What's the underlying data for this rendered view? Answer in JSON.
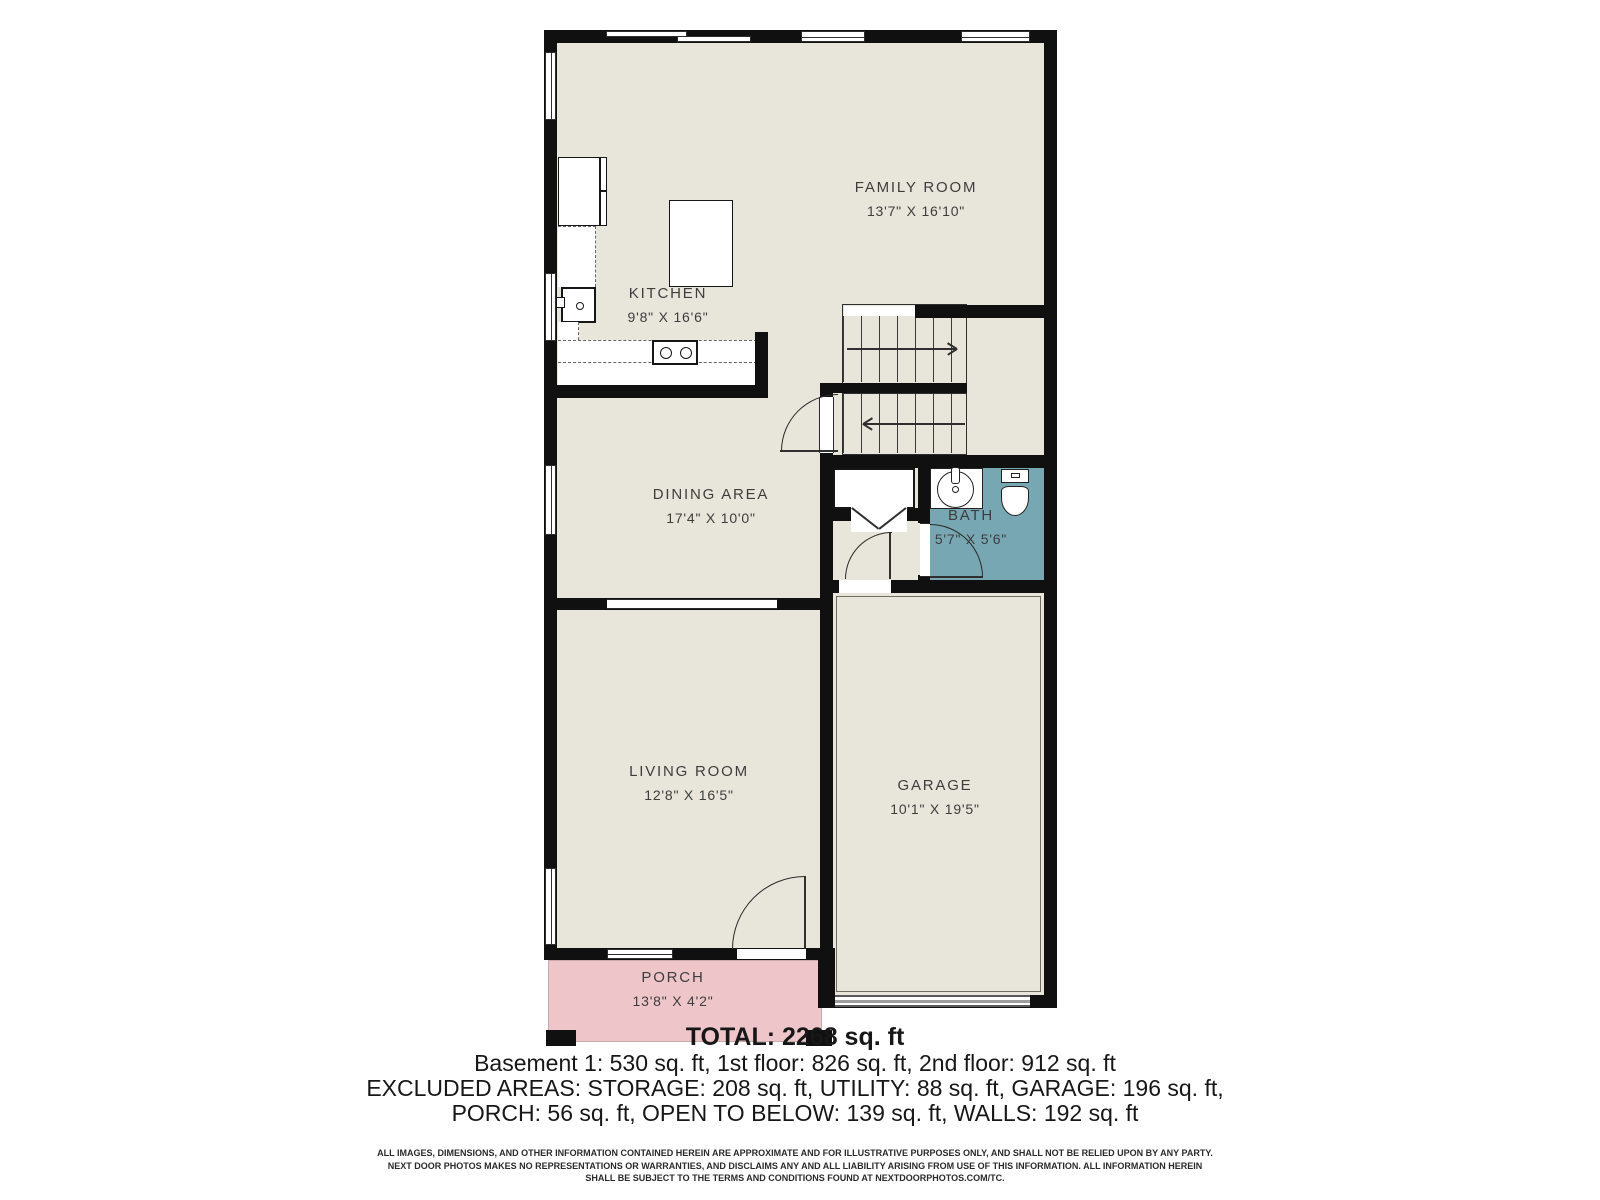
{
  "plan": {
    "rooms": {
      "family_room": {
        "name": "FAMILY ROOM",
        "dims": "13'7\" X 16'10\""
      },
      "kitchen": {
        "name": "KITCHEN",
        "dims": "9'8\" X 16'6\""
      },
      "dining_area": {
        "name": "DINING AREA",
        "dims": "17'4\" X 10'0\""
      },
      "bath": {
        "name": "BATH",
        "dims": "5'7\" X 5'6\""
      },
      "living_room": {
        "name": "LIVING ROOM",
        "dims": "12'8\" X 16'5\""
      },
      "garage": {
        "name": "GARAGE",
        "dims": "10'1\" X 19'5\""
      },
      "porch": {
        "name": "PORCH",
        "dims": "13'8\" X 4'2\""
      }
    },
    "colors": {
      "floor": "#e8e6da",
      "bath": "#78a7b4",
      "porch": "#eec6ca",
      "wall": "#101010"
    }
  },
  "summary": {
    "total": "TOTAL: 2268 sq. ft",
    "line1": "Basement 1: 530 sq. ft, 1st floor: 826 sq. ft, 2nd floor: 912 sq. ft",
    "line2": "EXCLUDED AREAS: STORAGE: 208 sq. ft, UTILITY: 88 sq. ft, GARAGE: 196 sq. ft,",
    "line3": "PORCH: 56 sq. ft, OPEN TO BELOW: 139 sq. ft, WALLS: 192 sq. ft"
  },
  "disclaimer": {
    "line1": "ALL IMAGES, DIMENSIONS, AND OTHER INFORMATION CONTAINED HEREIN ARE APPROXIMATE AND FOR ILLUSTRATIVE PURPOSES ONLY, AND SHALL NOT BE RELIED UPON BY ANY PARTY.",
    "line2": "NEXT DOOR PHOTOS MAKES NO REPRESENTATIONS OR WARRANTIES, AND DISCLAIMS ANY AND ALL LIABILITY ARISING FROM USE OF THIS INFORMATION. ALL INFORMATION HEREIN",
    "line3": "SHALL BE SUBJECT TO THE TERMS AND CONDITIONS FOUND AT NEXTDOORPHOTOS.COM/TC."
  }
}
